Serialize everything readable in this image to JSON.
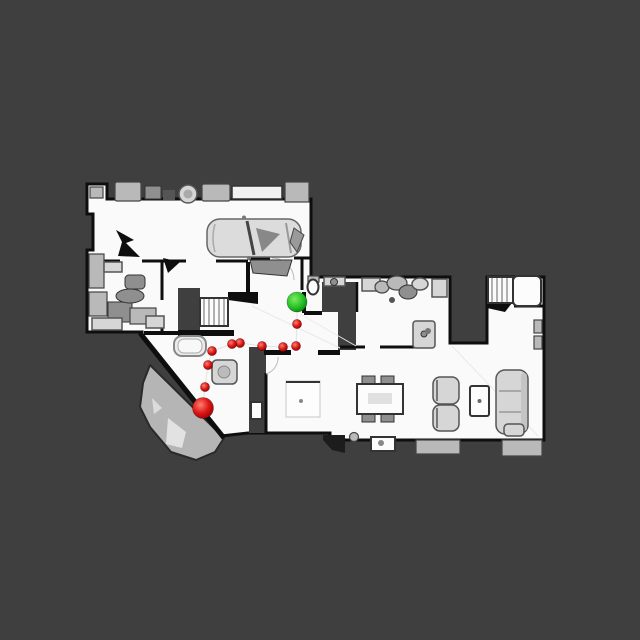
{
  "scene": {
    "background_color": "#3f3f3f",
    "wall_color": "#0e0e0e",
    "floor_color": "#fafafa",
    "patio_color": "#b5b5b5"
  },
  "markers": {
    "goal": {
      "x": 297,
      "y": 302,
      "r": 10,
      "color_center": "#80ea60",
      "color_mid": "#27c427",
      "color_edge": "#0a7c0a"
    },
    "start": {
      "x": 203,
      "y": 408,
      "r": 10.5,
      "color_center": "#ff7f6e",
      "color_mid": "#dd1414",
      "color_edge": "#8c0202"
    },
    "waypoints": {
      "r": 4.6,
      "points": [
        [
          297,
          324
        ],
        [
          296,
          346
        ],
        [
          283,
          347
        ],
        [
          262,
          346
        ],
        [
          240,
          343
        ],
        [
          232,
          344
        ],
        [
          212,
          351
        ],
        [
          208,
          365
        ],
        [
          205,
          387
        ]
      ]
    },
    "path_line_color": "#d8d8d8"
  }
}
